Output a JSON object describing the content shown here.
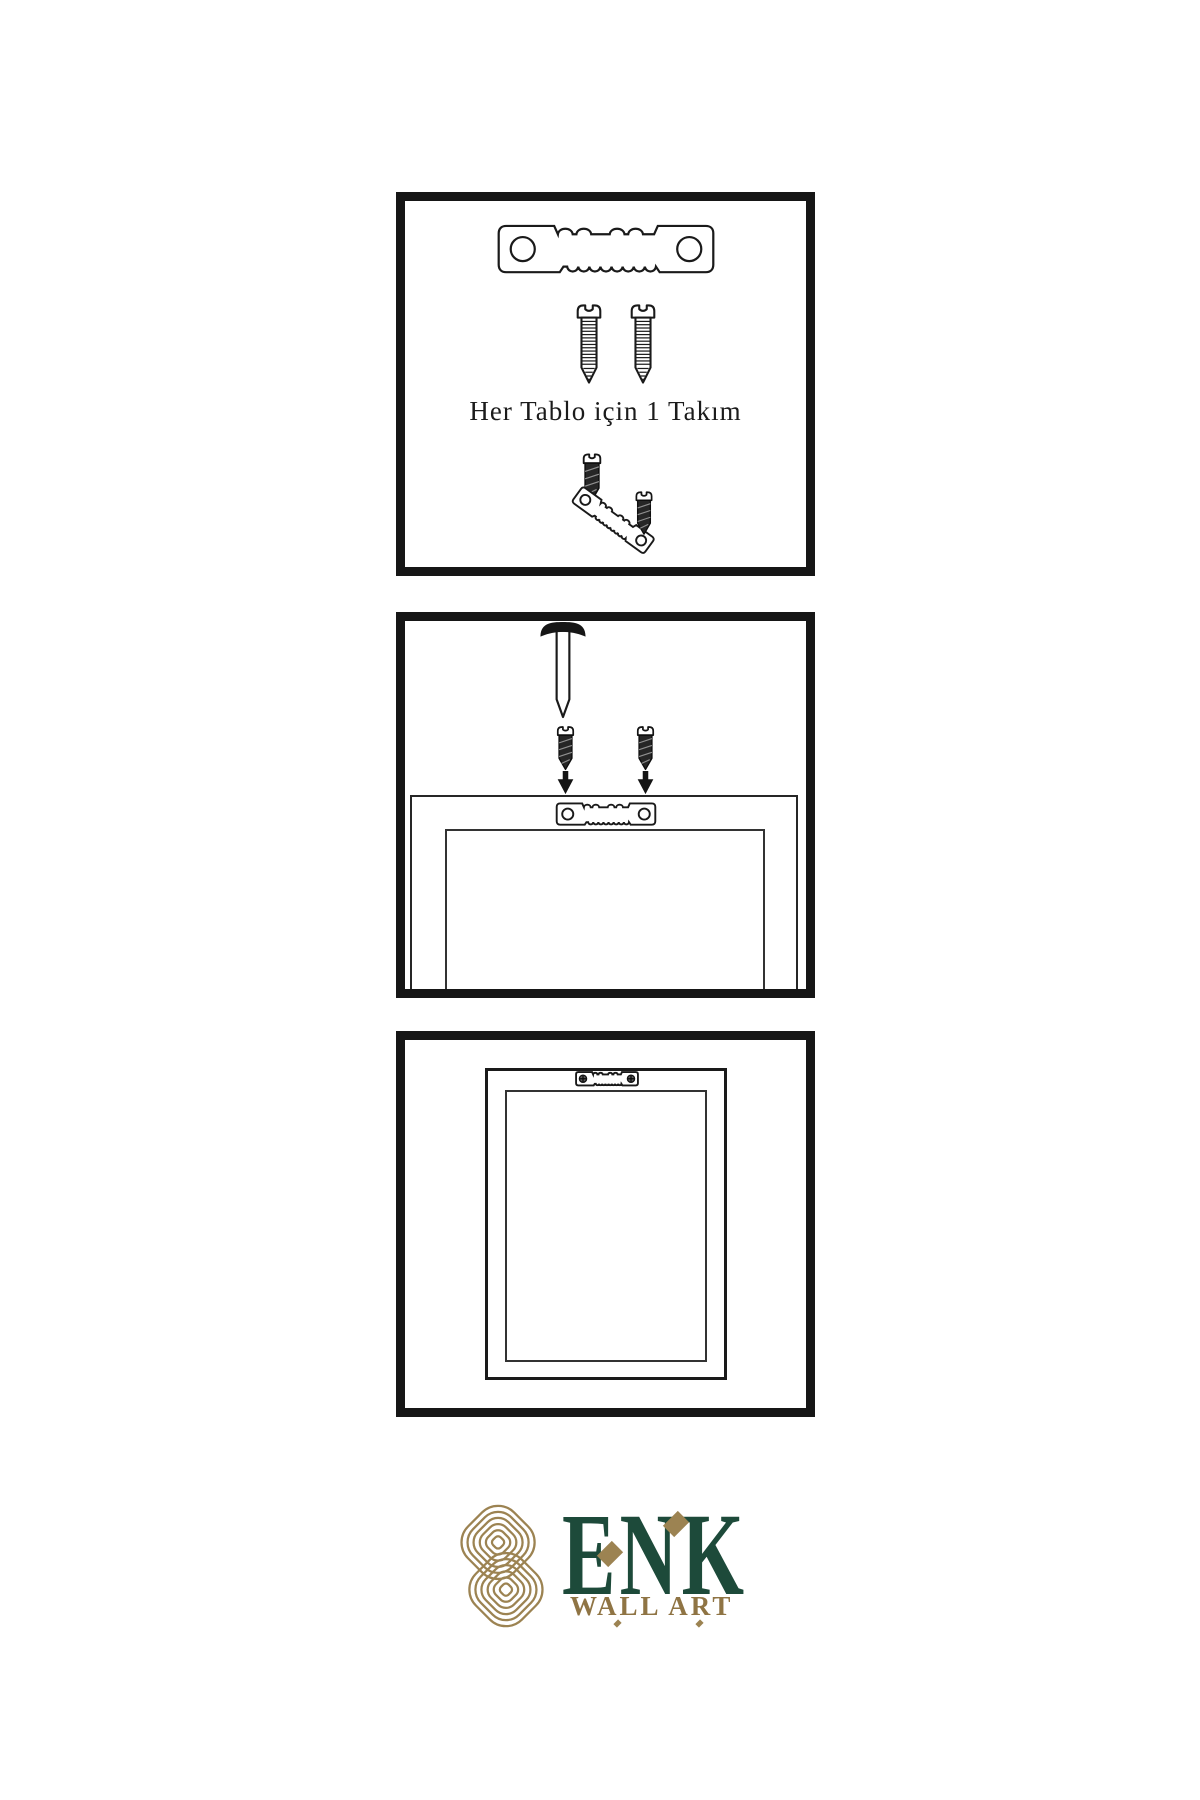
{
  "page": {
    "background_color": "#ffffff"
  },
  "colors": {
    "line_art": "#1a1a1a",
    "panel_border": "#161616",
    "brand_green": "#1d4a3a",
    "brand_gold": "#9c8352",
    "tagline_gold": "#8f7444"
  },
  "panels": [
    {
      "name": "hardware-kit-panel",
      "caption": "Her Tablo için 1 Takım",
      "icons": [
        "sawtooth-hanger-icon",
        "screw-icon",
        "screw-icon",
        "dark-screw-icon",
        "angled-sawtooth-hanger-icon",
        "dark-screw-icon"
      ]
    },
    {
      "name": "wall-installation-panel",
      "icons": [
        "nail-icon",
        "dark-screw-icon",
        "dark-screw-icon",
        "down-arrow-icon",
        "down-arrow-icon",
        "sawtooth-hanger-icon",
        "frame-back-outline"
      ]
    },
    {
      "name": "mounted-frame-panel",
      "icons": [
        "sawtooth-hanger-with-screws-icon",
        "frame-outline"
      ]
    }
  ],
  "logo": {
    "brand": "ENK",
    "tagline": "WALL ART",
    "emblem": "interlocked-knot-icon"
  }
}
